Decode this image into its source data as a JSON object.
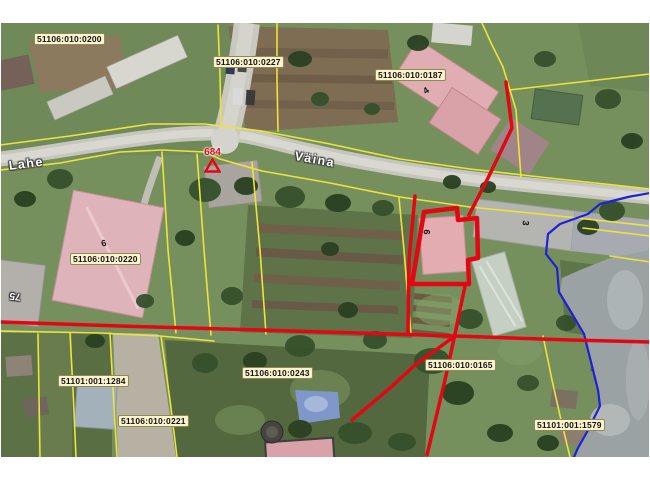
{
  "map": {
    "type": "cadastral-aerial-view",
    "parcel_labels": [
      {
        "text": "51106:010:0200",
        "x": 34,
        "y": 33
      },
      {
        "text": "51106:010:0227",
        "x": 213,
        "y": 56
      },
      {
        "text": "51106:010:0187",
        "x": 375,
        "y": 69
      },
      {
        "text": "51106:010:0220",
        "x": 70,
        "y": 253
      },
      {
        "text": "51101:001:1284",
        "x": 58,
        "y": 375
      },
      {
        "text": "51106:010:0221",
        "x": 118,
        "y": 415
      },
      {
        "text": "51106:010:0243",
        "x": 242,
        "y": 367
      },
      {
        "text": "51106:010:0165",
        "x": 425,
        "y": 359
      },
      {
        "text": "51101:001:1579",
        "x": 534,
        "y": 419
      }
    ],
    "street_labels": [
      {
        "text": "Lahe",
        "x": 8,
        "y": 159,
        "rotation": -7
      },
      {
        "text": "Väina",
        "x": 296,
        "y": 149,
        "rotation": 10
      }
    ],
    "building_numbers": [
      {
        "text": "4",
        "x": 421,
        "y": 88,
        "rotation": -35,
        "variant": "dark"
      },
      {
        "text": "6",
        "x": 100,
        "y": 239,
        "rotation": -15,
        "variant": "dark"
      },
      {
        "text": "6",
        "x": 432,
        "y": 230,
        "rotation": 95,
        "variant": "dark"
      },
      {
        "text": "3",
        "x": 531,
        "y": 221,
        "rotation": 95,
        "variant": "dark"
      },
      {
        "text": "75",
        "x": 20,
        "y": 302,
        "rotation": 187,
        "variant": "light"
      }
    ],
    "marker": {
      "label": "684",
      "x": 204,
      "y": 147
    },
    "layers": {
      "parcel_boundaries": {
        "color": "#ede33c",
        "width": 1.6,
        "paths": [
          [
            [
              0,
              145
            ],
            [
              70,
              136
            ],
            [
              150,
              124
            ],
            [
              205,
              124
            ],
            [
              262,
              131
            ],
            [
              330,
              144
            ],
            [
              400,
              159
            ],
            [
              470,
              169
            ],
            [
              540,
              177
            ],
            [
              650,
              189
            ]
          ],
          [
            [
              0,
              170
            ],
            [
              60,
              163
            ],
            [
              120,
              152
            ],
            [
              162,
              150
            ],
            [
              205,
              152
            ],
            [
              220,
              159
            ],
            [
              262,
              171
            ],
            [
              330,
              183
            ],
            [
              400,
              197
            ],
            [
              470,
              207
            ],
            [
              540,
              214
            ],
            [
              650,
              226
            ]
          ],
          [
            [
              218,
              25
            ],
            [
              220,
              75
            ],
            [
              221,
              124
            ]
          ],
          [
            [
              277,
              23
            ],
            [
              277,
              80
            ],
            [
              278,
              131
            ]
          ],
          [
            [
              482,
              23
            ],
            [
              492,
              45
            ],
            [
              503,
              67
            ],
            [
              516,
              110
            ],
            [
              521,
              177
            ]
          ],
          [
            [
              509,
              90
            ],
            [
              580,
              82
            ],
            [
              650,
              74
            ]
          ],
          [
            [
              162,
              152
            ],
            [
              168,
              250
            ],
            [
              176,
              333
            ]
          ],
          [
            [
              197,
              154
            ],
            [
              204,
              250
            ],
            [
              211,
              335
            ]
          ],
          [
            [
              252,
              162
            ],
            [
              260,
              250
            ],
            [
              266,
              334
            ]
          ],
          [
            [
              38,
              334
            ],
            [
              40,
              457
            ]
          ],
          [
            [
              70,
              333
            ],
            [
              73,
              390
            ],
            [
              76,
              457
            ]
          ],
          [
            [
              110,
              333
            ],
            [
              113,
              390
            ],
            [
              117,
              457
            ]
          ],
          [
            [
              161,
              336
            ],
            [
              170,
              400
            ],
            [
              177,
              457
            ]
          ],
          [
            [
              0,
              331
            ],
            [
              100,
              333
            ],
            [
              160,
              336
            ],
            [
              214,
              341
            ]
          ],
          [
            [
              399,
              198
            ],
            [
              404,
              250
            ],
            [
              408,
              300
            ],
            [
              411,
              334
            ]
          ],
          [
            [
              543,
              336
            ],
            [
              552,
              380
            ],
            [
              561,
              420
            ],
            [
              570,
              457
            ]
          ],
          [
            [
              583,
              228
            ],
            [
              650,
              236
            ]
          ],
          [
            [
              610,
              256
            ],
            [
              650,
              262
            ]
          ]
        ]
      },
      "water_boundary": {
        "color": "#2020d8",
        "width": 2.2,
        "paths": [
          [
            [
              650,
              193
            ],
            [
              628,
              197
            ],
            [
              600,
              204
            ],
            [
              588,
              214
            ],
            [
              560,
              224
            ],
            [
              548,
              234
            ],
            [
              546,
              254
            ],
            [
              557,
              268
            ],
            [
              559,
              292
            ],
            [
              571,
              312
            ],
            [
              584,
              334
            ],
            [
              591,
              362
            ],
            [
              598,
              390
            ],
            [
              600,
              406
            ],
            [
              587,
              432
            ],
            [
              578,
              448
            ],
            [
              574,
              457
            ]
          ]
        ]
      },
      "highlight_lines": {
        "color": "#e30613",
        "width": 3.5,
        "paths": [
          [
            [
              506,
              82
            ],
            [
              512,
              128
            ],
            [
              488,
              178
            ],
            [
              469,
              215
            ]
          ],
          [
            [
              465,
              286
            ],
            [
              455,
              334
            ],
            [
              445,
              380
            ],
            [
              427,
              455
            ]
          ],
          [
            [
              0,
              322
            ],
            [
              120,
              326
            ],
            [
              260,
              330
            ],
            [
              390,
              334
            ],
            [
              455,
              336
            ],
            [
              570,
              340
            ],
            [
              650,
              342
            ]
          ],
          [
            [
              455,
              336
            ],
            [
              415,
              365
            ],
            [
              390,
              388
            ],
            [
              352,
              420
            ]
          ],
          [
            [
              415,
              196
            ],
            [
              409,
              260
            ],
            [
              408,
              333
            ]
          ]
        ]
      },
      "selected_parcel_outline": {
        "color": "#e30613",
        "width": 4.5,
        "closed": true,
        "paths": [
          [
            [
              424,
              212
            ],
            [
              457,
              208
            ],
            [
              458,
              220
            ],
            [
              477,
              218
            ],
            [
              478,
              258
            ],
            [
              468,
              260
            ],
            [
              469,
              284
            ],
            [
              412,
              284
            ]
          ]
        ]
      }
    },
    "colors": {
      "label_background": "#fbf3cd",
      "label_border": "#8f8a55",
      "label_text": "#141414",
      "marker_red": "#e30613",
      "parcel_boundary_yellow": "#ede33c",
      "water_boundary_blue": "#2020d8",
      "street_label_text": "#ffffff"
    }
  }
}
